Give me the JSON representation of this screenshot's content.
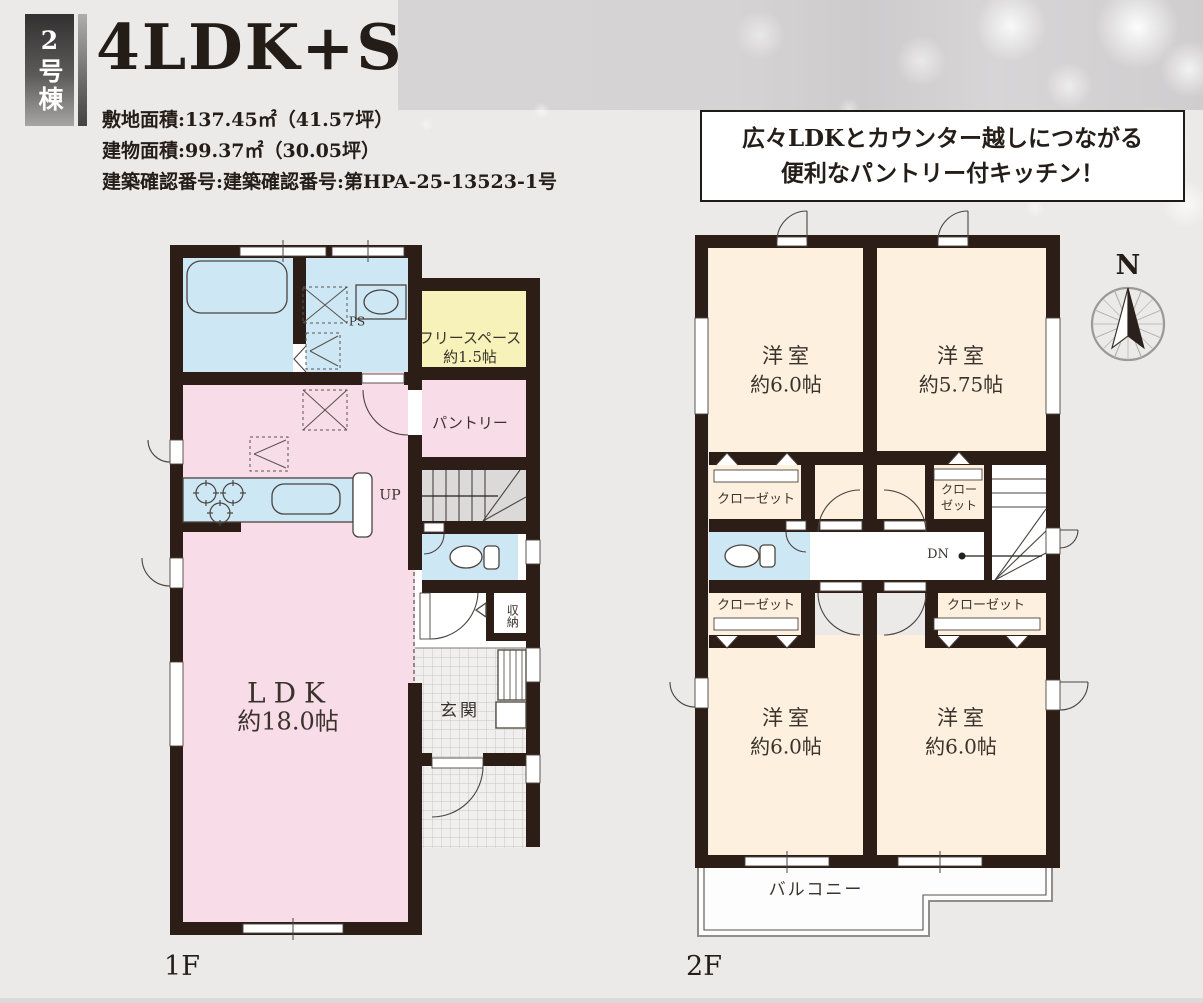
{
  "header": {
    "unit_badge": "2号棟",
    "title": "4LDK+S",
    "specs": [
      "敷地面積:137.45㎡（41.57坪）",
      "建物面積:99.37㎡（30.05坪）",
      "建築確認番号:建築確認番号:第HPA-25-13523-1号"
    ],
    "callout": {
      "line1": "広々LDKとカウンター越しにつながる",
      "line2": "便利なパントリー付キッチン！"
    }
  },
  "compass": {
    "north_label": "N"
  },
  "floor1": {
    "floor_label": "1F",
    "ldk_name": "LDK",
    "ldk_size": "約18.0帖",
    "free_space_name": "フリースペース",
    "free_space_size": "約1.5帖",
    "pantry_label": "パントリー",
    "entrance_label": "玄関",
    "storage_label": "収納",
    "pipe_space_label": "PS",
    "stairs_up_label": "UP"
  },
  "floor2": {
    "floor_label": "2F",
    "bedrooms": [
      {
        "name": "洋室",
        "size": "約6.0帖"
      },
      {
        "name": "洋室",
        "size": "約5.75帖"
      },
      {
        "name": "洋室",
        "size": "約6.0帖"
      },
      {
        "name": "洋室",
        "size": "約6.0帖"
      }
    ],
    "closet_labels": [
      "クローゼット",
      "クローゼット",
      "クローゼット"
    ],
    "small_closet": {
      "line1": "クロー",
      "line2": "ゼット"
    },
    "stairs_down_label": "DN",
    "balcony_label": "バルコニー"
  },
  "colors": {
    "wall": "#2c1d16",
    "room_pink": "#f8dce8",
    "room_blue": "#cde7f5",
    "room_yellow": "#f7f2ba",
    "room_cream": "#fdf0de",
    "stair_gray": "#dcdad8",
    "background": "#eceae9"
  }
}
